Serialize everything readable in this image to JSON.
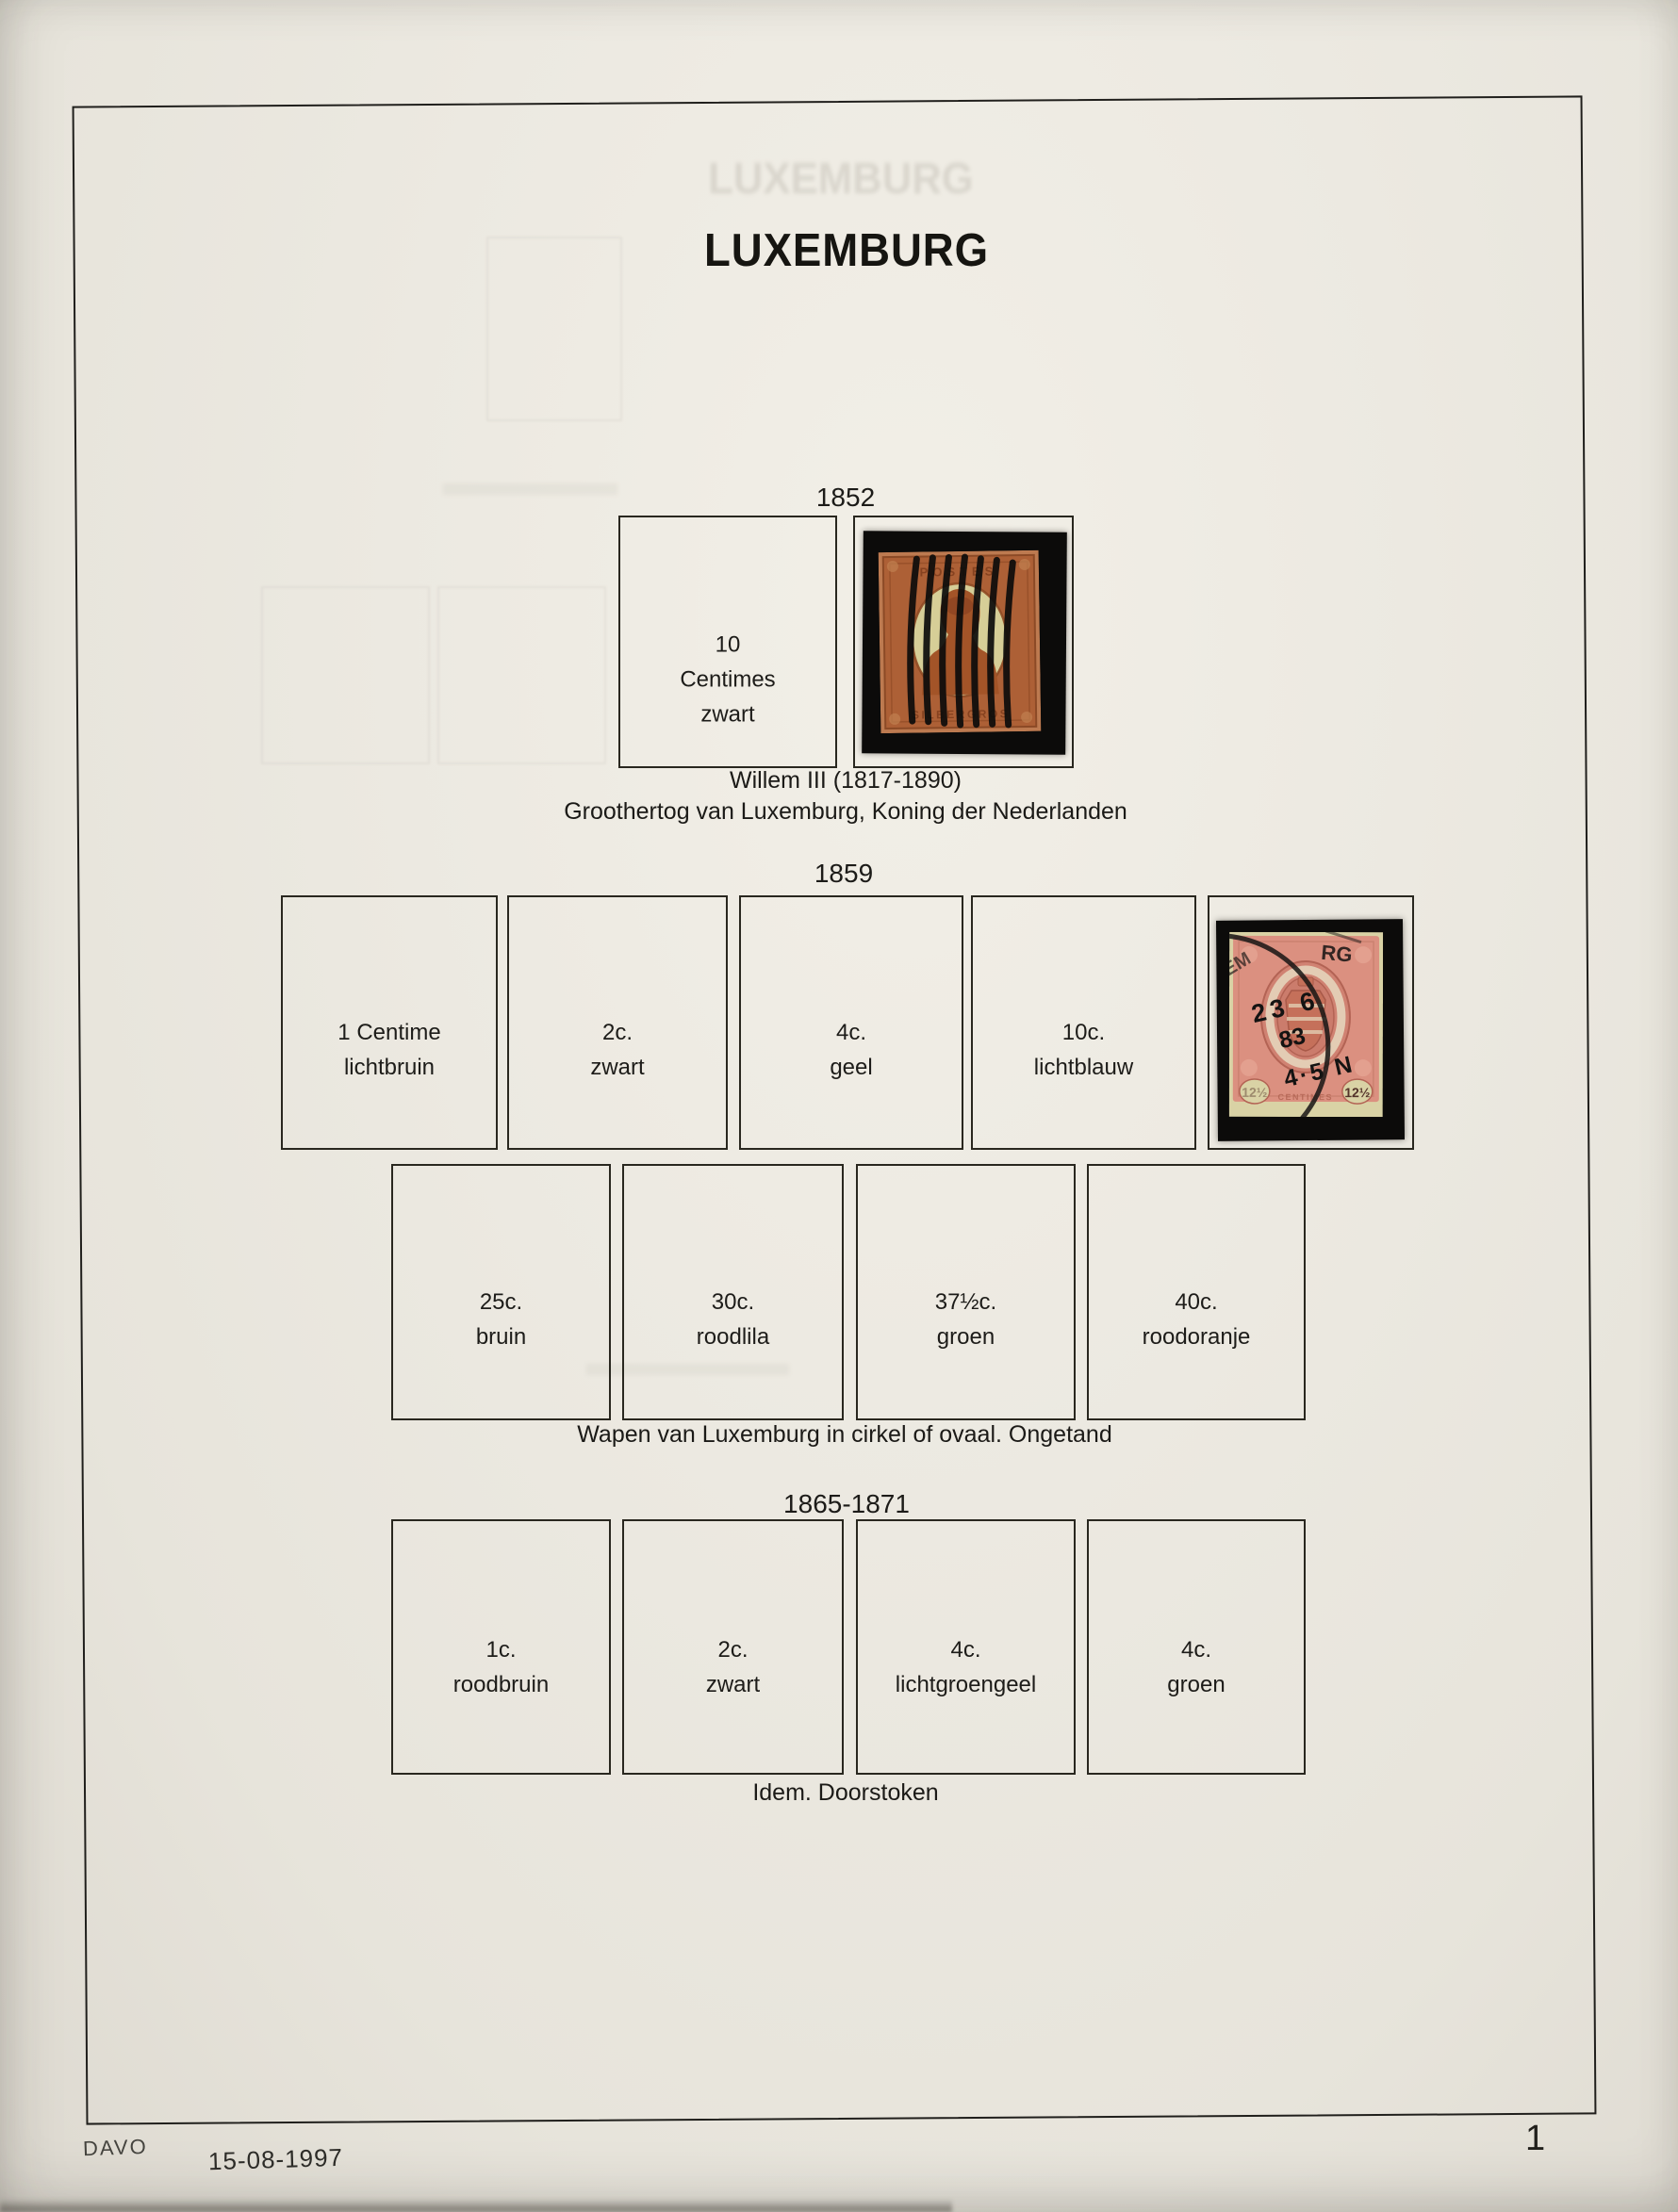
{
  "title": "LUXEMBURG",
  "ghost_title": "LUXEMBURG",
  "sections": {
    "y1852": {
      "year": "1852",
      "cell0_label": "10 Centimes\nzwart",
      "caption": "Willem III (1817-1890)\nGroothertog van Luxemburg, Koning der Nederlanden"
    },
    "y1859": {
      "year": "1859",
      "row1": [
        "1 Centime\nlichtbruin",
        "2c.\nzwart",
        "4c.\ngeel",
        "10c.\nlichtblauw"
      ],
      "row2": [
        "25c.\nbruin",
        "30c.\nroodlila",
        "37½c.\ngroen",
        "40c.\nroodoranje"
      ],
      "caption": "Wapen van Luxemburg in cirkel of ovaal. Ongetand"
    },
    "y1865": {
      "year": "1865-1871",
      "row1": [
        "1c.\nroodbruin",
        "2c.\nzwart",
        "4c.\nlichtgroengeel",
        "4c.\ngroen"
      ],
      "caption": "Idem. Doorstoken"
    }
  },
  "stamps": {
    "s1852": {
      "name": "Willem III 10 Centimes used, bar cancel",
      "top_text": "POSTES",
      "bottom_text": "SILBERGROS"
    },
    "s1859": {
      "name": "Wapen van Luxemburg 12½c rose, circular datestamp",
      "cancel_day": "23 6",
      "cancel_year": "83",
      "cancel_time": "4·5 N",
      "arc_left": "EM",
      "arc_right": "RG",
      "value": "12½",
      "bottom_text": "CENTIMES"
    }
  },
  "footer": {
    "publisher": "DAVO",
    "date": "15-08-1997",
    "page_number": "1"
  },
  "colors": {
    "paper": "#ece9e1",
    "ink": "#1c1b18",
    "box_border": "#29271f",
    "mount_black": "#0c0b0a",
    "stamp1852_body": "#ad6036",
    "stamp1852_oval": "#d6ce97",
    "stamp1859_body": "#db9080",
    "stamp1859_pale": "#d9d2a5"
  }
}
